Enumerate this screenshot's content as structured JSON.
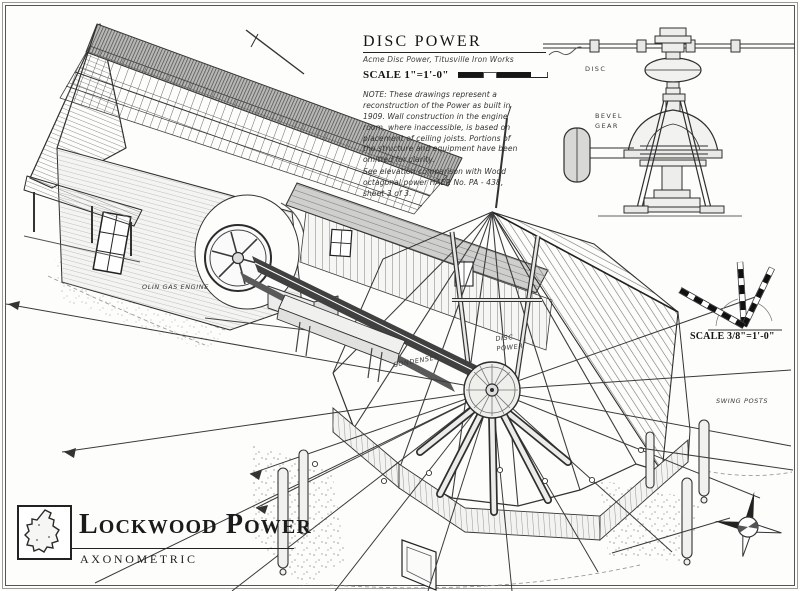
{
  "sheet": {
    "paper_color": "#fdfdfb",
    "ink_color": "#2b2b2b"
  },
  "title_block": {
    "title": "DISC POWER",
    "subtitle": "Acme Disc Power, Titusville Iron Works",
    "scale_label": "SCALE 1\"=1'-0\""
  },
  "notes": {
    "note": "NOTE:  These drawings represent a reconstruction of the Power as built in 1909.  Wall construction in the engine room, where inaccessible, is based on placement of ceiling joists.  Portions of the structure and equipment have been omitted for clarity.",
    "reference": "See elevation comparison with Wood octagonal power HAER No. PA - 438, sheet 3 of 3."
  },
  "detail_labels": {
    "disc": "DISC",
    "bevel_gear": "BEVEL GEAR"
  },
  "drawing_labels": {
    "engine": "OLIN GAS ENGINE",
    "condenser": "CONDENSER",
    "disc_power": "DISC POWER",
    "swing_posts": "SWING POSTS"
  },
  "axo_scale": {
    "label": "SCALE 3/8\"=1'-0\""
  },
  "footer": {
    "title": "Lockwood Power",
    "subtitle": "AXONOMETRIC"
  }
}
